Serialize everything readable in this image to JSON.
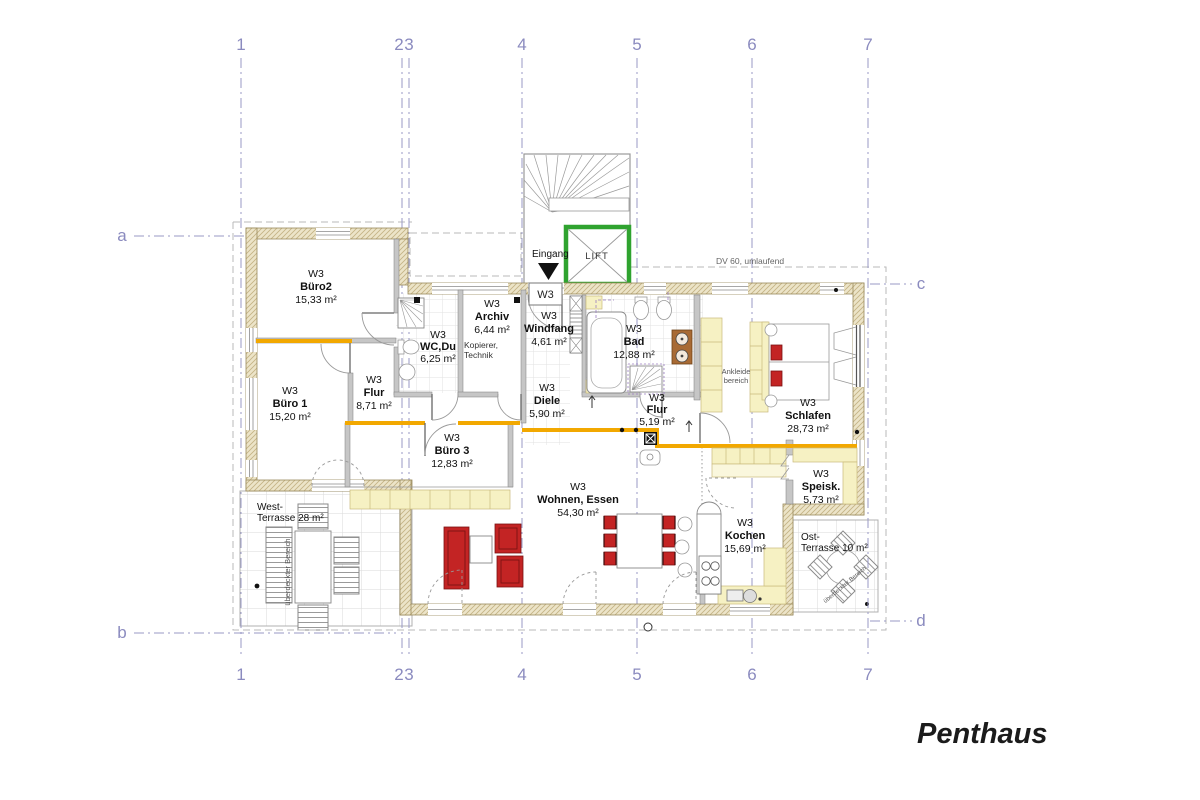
{
  "title": "Penthaus",
  "grid": {
    "cols": [
      "1",
      "2",
      "3",
      "4",
      "5",
      "6",
      "7"
    ],
    "rows": [
      "a",
      "b",
      "c",
      "d"
    ]
  },
  "notes": {
    "roof": "DV 60, umlaufend",
    "entrance": "Eingang",
    "lift": "LIFT",
    "entry_box": "W3",
    "covered": "überdeckter Bereich",
    "archiv_note1": "Kopierer,",
    "archiv_note2": "Technik",
    "ankleide1": "Ankleide",
    "ankleide2": "bereich"
  },
  "rooms": [
    {
      "code": "W3",
      "name": "Büro2",
      "area": "15,33 m²"
    },
    {
      "code": "W3",
      "name": "Büro 1",
      "area": "15,20 m²"
    },
    {
      "code": "W3",
      "name": "Flur",
      "area": "8,71 m²"
    },
    {
      "code": "W3",
      "name": "WC,Du",
      "area": "6,25 m²"
    },
    {
      "code": "W3",
      "name": "Archiv",
      "area": "6,44 m²"
    },
    {
      "code": "W3",
      "name": "Windfang",
      "area": "4,61 m²"
    },
    {
      "code": "W3",
      "name": "Diele",
      "area": "5,90 m²"
    },
    {
      "code": "W3",
      "name": "Bad",
      "area": "12,88 m²"
    },
    {
      "code": "W3",
      "name": "Flur",
      "area": "5,19 m²"
    },
    {
      "code": "W3",
      "name": "Schlafen",
      "area": "28,73 m²"
    },
    {
      "code": "W3",
      "name": "Büro 3",
      "area": "12,83 m²"
    },
    {
      "code": "W3",
      "name": "Wohnen, Essen",
      "area": "54,30 m²"
    },
    {
      "code": "W3",
      "name": "Kochen",
      "area": "15,69 m²"
    },
    {
      "code": "W3",
      "name": "Speisk.",
      "area": "5,73 m²"
    }
  ],
  "terraces": {
    "west1": "West-",
    "west2": "Terrasse 28 m²",
    "ost1": "Ost-",
    "ost2": "Terrasse 10 m²"
  }
}
